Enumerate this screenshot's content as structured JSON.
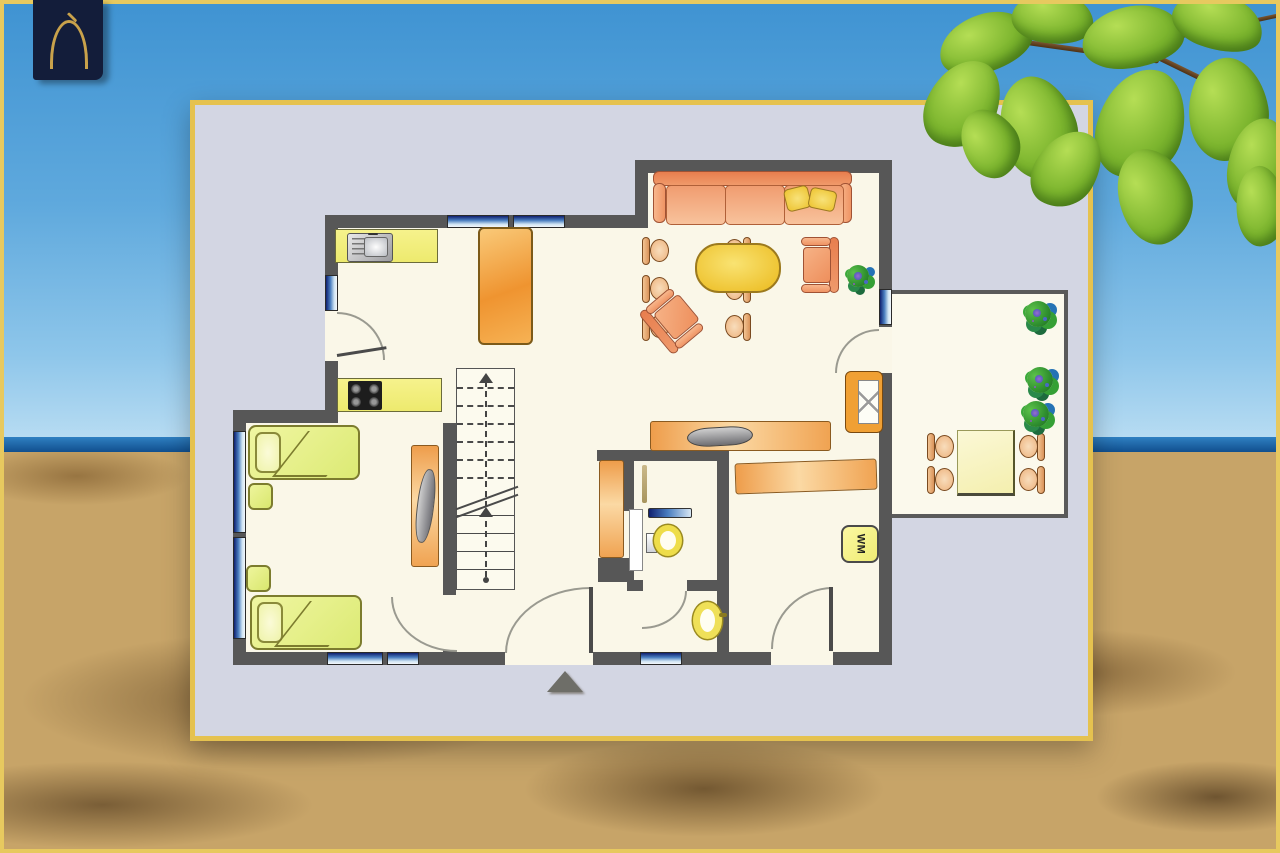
{
  "logo": {
    "icon": "pointed-arch-house-icon"
  },
  "labels": {
    "washing_machine": "WM"
  },
  "scene": {
    "description_icons": [
      "sky",
      "sea-horizon",
      "sandy-beach",
      "tree-leaves"
    ],
    "colors": {
      "frame_gold": "#e7c95f",
      "sky_top": "#3f93d2",
      "sky_horizon": "#bfe0f4",
      "sea": "#11508f",
      "sand": "#c7a468",
      "leaf_green": "#7cb52e",
      "logo_navy": "#131d3a",
      "logo_gold": "#c9a24b"
    }
  },
  "floor_plan": {
    "panel": {
      "background": "#d3d6e3",
      "border_gold": "#e5c24f"
    },
    "colors": {
      "wall": "#575757",
      "floor": "#faf7e8",
      "window_blue": "#4a7ec0",
      "counter_yellow": "#f2ef7d",
      "furniture_orange": "#f2a85c",
      "sofa_salmon": "#ef9468",
      "coffee_table_yellow": "#eec22e",
      "bed_green": "#e6ee8a",
      "terrace_table_cream": "#f8f4c0"
    },
    "icon_legend": [
      "kitchen-sink-icon",
      "stove-cooktop-icon",
      "dining-table-icon",
      "chair-icon",
      "sofa-icon",
      "coffee-table-icon",
      "armchair-icon",
      "houseplant-icon",
      "fireplace-icon",
      "tv-sideboard-icon",
      "staircase-icon",
      "bed-icon",
      "nightstand-icon",
      "wardrobe-icon",
      "radiator-icon",
      "mirror-icon",
      "washbasin-icon",
      "toilet-icon",
      "pedestal-sink-icon",
      "washing-machine-icon",
      "terrace-table-icon",
      "terrace-plant-icon",
      "entrance-arrow-icon",
      "door-swing-icon",
      "window-icon"
    ]
  }
}
